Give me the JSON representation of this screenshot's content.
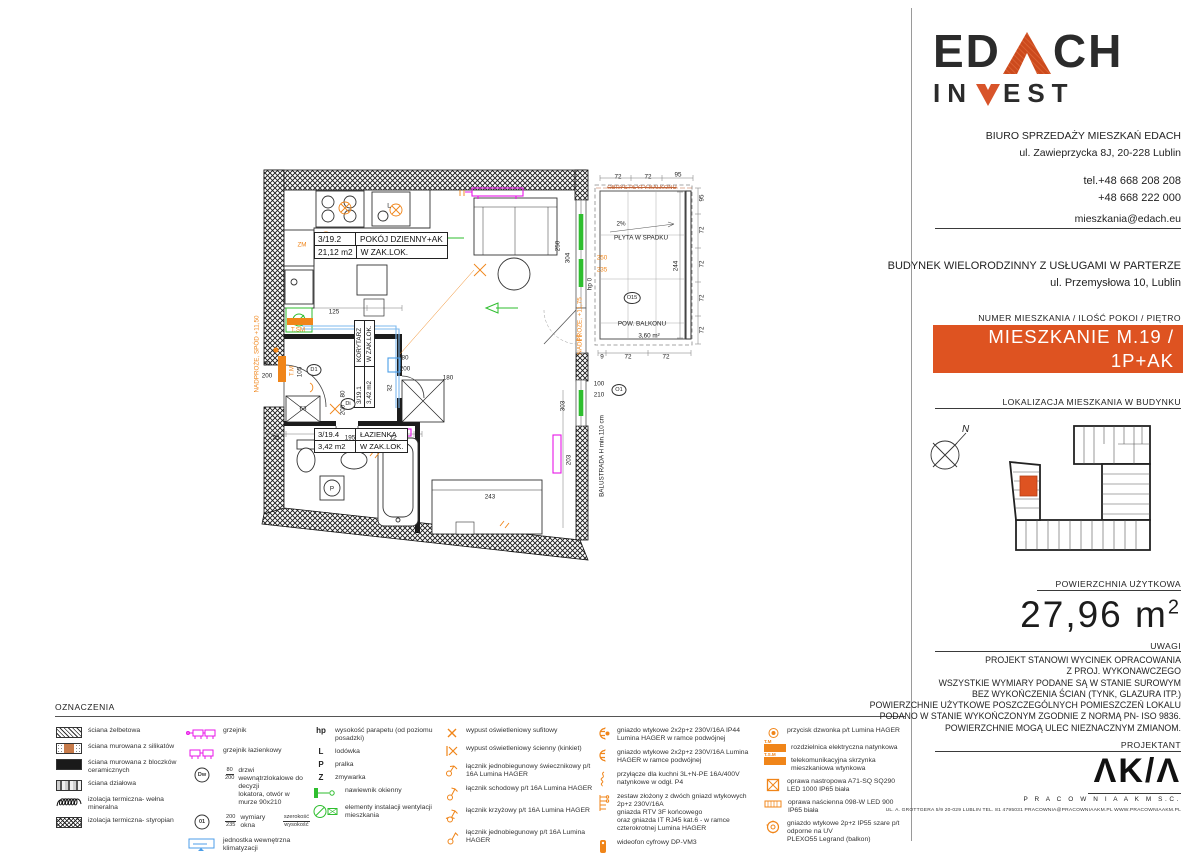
{
  "right_panel": {
    "logo_line1_a": "ED",
    "logo_line1_b": "CH",
    "logo_line2_a": "IN",
    "logo_line2_b": "EST",
    "office_line1": "BIURO SPRZEDAŻY MIESZKAŃ EDACH",
    "office_line2": "ul. Zawieprzycka 8J, 20-228 Lublin",
    "tel1": "tel.+48 668 208 208",
    "tel2": "+48 668 222 000",
    "email": "mieszkania@edach.eu",
    "building_line1": "BUDYNEK WIELORODZINNY Z USŁUGAMI W PARTERZE",
    "building_line2": "ul. Przemysłowa 10, Lublin",
    "unit_header": "NUMER MIESZKANIA / ILOŚĆ POKOI / PIĘTRO",
    "banner_line1": "MIESZKANIE M.19 / 1P+AK",
    "banner_line2": "PIĘTRO 3",
    "location_header": "LOKALIZACJA MIESZKANIA W BUDYNKU",
    "compass_n": "N",
    "area_header": "POWIERZCHNIA UŻYTKOWA",
    "area_value": "27,96 m",
    "area_sup": "2",
    "uwagi_header": "UWAGI",
    "uwagi_lines": [
      "PROJEKT STANOWI WYCINEK OPRACOWANIA",
      "Z PROJ. WYKONAWCZEGO",
      "WSZYSTKIE WYMIARY PODANE SĄ W STANIE SUROWYM",
      "BEZ WYKOŃCZENIA ŚCIAN (TYNK, GLAZURA ITP.)",
      "POWIERZCHNIE UŻYTKOWE POSZCZEGÓLNYCH POMIESZCZEŃ LOKALU",
      "PODANO W STANIE WYKOŃCZONYM ZGODNIE Z NORMĄ PN- ISO 9836.",
      "POWIERZCHNIE MOGĄ ULEC NIEZNACZNYM ZMIANOM."
    ],
    "projektant_header": "PROJEKTANT",
    "akm_logo": "ΛΚ/Λ",
    "akm_sub": "P R A C O W N I A   A K M   S.C.",
    "akm_footer": "UL. A. GROTTGERA 5/9  20-029 LUBLIN  TEL. 81 4795031  PRACOWNIA@PRACOWNIAAKM.PL  WWW.PRACOWNIAAKM.PL"
  },
  "colors": {
    "accent_orange": "#DE5321",
    "symbol_orange": "#F08519",
    "magenta": "#E816E8",
    "green": "#2EBE2E",
    "blue": "#4C9EE8"
  },
  "legend": {
    "title": "OZNACZENIA",
    "columns": [
      {
        "items": [
          {
            "icon": "hatch",
            "label": "ściana żelbetowa"
          },
          {
            "icon": "silikat",
            "label": "ściana murowana z silikatów"
          },
          {
            "icon": "solid",
            "label": "ściana murowana z bloczków ceramicznych"
          },
          {
            "icon": "dzialowa",
            "label": "ściana działowa"
          },
          {
            "icon": "wool",
            "label": "izolacja termiczna- wełna mineralna"
          },
          {
            "icon": "styro",
            "label": "izolacja termiczna- styropian"
          }
        ]
      },
      {
        "items": [
          {
            "icon": "radiator",
            "label": "grzejnik"
          },
          {
            "icon": "radiator-bath",
            "label": "grzejnik łazienkowy"
          },
          {
            "icon": "circle",
            "cap": "Dw",
            "fr": "80/200",
            "label": "drzwi wewnątrzlokalowe do decyzji\nlokatora, otwór w murze 90x210"
          },
          {
            "icon": "circle",
            "cap": "01",
            "fr": "200/235",
            "label": "wymiary okna",
            "fr2": "szerokość/wysokość"
          },
          {
            "icon": "klima",
            "label": "jednostka wewnętrzna klimatyzacji"
          }
        ]
      },
      {
        "items": [
          {
            "icon": "letter",
            "cap": "hp",
            "label": "wysokość parapetu (od poziomu posadzki)"
          },
          {
            "icon": "letter",
            "cap": "L",
            "label": "lodówka"
          },
          {
            "icon": "letter",
            "cap": "P",
            "label": "pralka"
          },
          {
            "icon": "letter",
            "cap": "Z",
            "label": "zmywarka"
          },
          {
            "icon": "nawiewnik",
            "label": "nawiewnik okienny"
          },
          {
            "icon": "vent",
            "label": "elementy instalacji wentylacji mieszkania"
          }
        ]
      },
      {
        "items": [
          {
            "icon": "lampx",
            "label": "wypust oświetleniowy sufitowy"
          },
          {
            "icon": "lampwall",
            "label": "wypust oświetleniowy ścienny (kinkiet)"
          },
          {
            "icon": "sw-swiecznik",
            "label": "łącznik jednobiegunowy świecznikowy  p/t 16A Lumina HAGER"
          },
          {
            "icon": "sw-schodowy",
            "label": "łącznik schodowy  p/t 16A Lumina HAGER"
          },
          {
            "icon": "sw-krzyzowy",
            "label": "łącznik krzyżowy  p/t 16A Lumina HAGER"
          },
          {
            "icon": "sw-jedno",
            "label": "łącznik jednobiegunowy p/t 16A Lumina HAGER"
          }
        ]
      },
      {
        "items": [
          {
            "icon": "socket44",
            "label": "gniazdo wtykowe 2x2p+z 230V/16A IP44 Lumina HAGER w ramce podwójnej"
          },
          {
            "icon": "socket",
            "label": "gniazdo wtykowe 2x2p+z 230V/16A Lumina HAGER w ramce podwójnej"
          },
          {
            "icon": "kuchnia",
            "label": "przyłącze dla kuchni 3L+N-PE 16A/400V natynkowe w odgł. P4"
          },
          {
            "icon": "zestaw",
            "label": "zestaw złożony z dwóch gniazd wtykowych 2p+z 230V/16A\ngniazda RTV 3F końcowego\noraz gniazda IT RJ45 kat.6 - w ramce czterokrotnej Lumina HAGER"
          },
          {
            "icon": "wideofon",
            "label": "wideofon cyfrowy DP-VM3"
          }
        ]
      },
      {
        "items": [
          {
            "icon": "dzwonek",
            "label": "przycisk dzwonka p/t Lumina HAGER"
          },
          {
            "icon": "boxfill",
            "capTop": "T.M",
            "label": "rozdzielnica elektryczna natynkowa"
          },
          {
            "icon": "boxfill",
            "capTop": "T.S.M",
            "label": "telekomunikacyjna skrzynka mieszkaniowa wtynkowa"
          },
          {
            "icon": "oprawa-sufit",
            "label": "oprawa nastropowa A71-SQ SQ290 LED 1000 IP65 biała"
          },
          {
            "icon": "oprawa-scienna",
            "label": "oprawa naścienna 098-W LED 900 IP65 biała"
          },
          {
            "icon": "gniazdo55",
            "label": "gniazdo wtykowe 2p+z IP55 szare p/t odporne na UV\nPLEXO55 Legrand (balkon)"
          }
        ]
      }
    ]
  },
  "plan": {
    "rooms": {
      "living": {
        "num": "3/19.2",
        "name": "POKÓJ DZIENNY+AK",
        "area": "21,12 m2",
        "note": "W ZAK.LOK."
      },
      "corridor": {
        "num": "3/19.1",
        "name": "KORYTARZ",
        "area": "3,42 m2",
        "note": "W ZAK.LOK."
      },
      "bath": {
        "num": "3/19.4",
        "name": "ŁAZIENKA",
        "area": "3,42 m2",
        "note": "W ZAK.LOK."
      }
    },
    "labels": [
      {
        "t": "72",
        "x": 368,
        "y": 19
      },
      {
        "t": "72",
        "x": 398,
        "y": 19
      },
      {
        "t": "95",
        "x": 428,
        "y": 17
      },
      {
        "t": "9",
        "x": 352,
        "y": 199
      },
      {
        "t": "72",
        "x": 378,
        "y": 199
      },
      {
        "t": "72",
        "x": 416,
        "y": 199
      },
      {
        "t": "95",
        "x": 452,
        "y": 40,
        "r": 1
      },
      {
        "t": "72",
        "x": 452,
        "y": 72,
        "r": 1
      },
      {
        "t": "72",
        "x": 452,
        "y": 106,
        "r": 1
      },
      {
        "t": "72",
        "x": 452,
        "y": 140,
        "r": 1
      },
      {
        "t": "72",
        "x": 452,
        "y": 172,
        "r": 1
      },
      {
        "t": "244",
        "x": 426,
        "y": 108,
        "r": 1
      },
      {
        "t": "304",
        "x": 318,
        "y": 100,
        "r": 1
      },
      {
        "t": "250",
        "x": 308,
        "y": 88,
        "r": 1
      },
      {
        "t": "hp 0",
        "x": 340,
        "y": 126,
        "r": 1
      },
      {
        "t": "250",
        "x": 352,
        "y": 100,
        "c": "org"
      },
      {
        "t": "235",
        "x": 352,
        "y": 112,
        "c": "org"
      },
      {
        "t": "2%",
        "x": 371,
        "y": 66
      },
      {
        "t": "PŁYTA W SPADKU",
        "x": 391,
        "y": 80
      },
      {
        "t": "POW. BALKONU",
        "x": 392,
        "y": 166
      },
      {
        "t": "3,60 m²",
        "x": 399,
        "y": 178
      },
      {
        "t": "OBRYS PŁYTY BALKONU",
        "x": 392,
        "y": 30,
        "c": "strike"
      },
      {
        "t": "O15",
        "x": 382,
        "y": 140,
        "c": "circ"
      },
      {
        "t": "125",
        "x": 84,
        "y": 154
      },
      {
        "t": "80",
        "x": 155,
        "y": 200
      },
      {
        "t": "200",
        "x": 155,
        "y": 211
      },
      {
        "t": "180",
        "x": 198,
        "y": 220
      },
      {
        "t": "90",
        "x": 17,
        "y": 206
      },
      {
        "t": "200",
        "x": 17,
        "y": 218
      },
      {
        "t": "105",
        "x": 50,
        "y": 214,
        "r": 1
      },
      {
        "t": "D1",
        "x": 64,
        "y": 212,
        "c": "circ"
      },
      {
        "t": "Di",
        "x": 98,
        "y": 246,
        "c": "circ"
      },
      {
        "t": "63",
        "x": 53,
        "y": 251
      },
      {
        "t": "32",
        "x": 140,
        "y": 230,
        "r": 1
      },
      {
        "t": "80",
        "x": 93,
        "y": 236,
        "r": 1
      },
      {
        "t": "200",
        "x": 93,
        "y": 252,
        "r": 1
      },
      {
        "t": "L",
        "x": 139,
        "y": 48
      },
      {
        "t": "P",
        "x": 82,
        "y": 331
      },
      {
        "t": "35",
        "x": 26,
        "y": 280
      },
      {
        "t": "195",
        "x": 100,
        "y": 280
      },
      {
        "t": "12",
        "x": 143,
        "y": 280
      },
      {
        "t": "243",
        "x": 240,
        "y": 339
      },
      {
        "t": "303",
        "x": 313,
        "y": 248,
        "r": 1
      },
      {
        "t": "203",
        "x": 319,
        "y": 302,
        "r": 1
      },
      {
        "t": "100",
        "x": 349,
        "y": 226
      },
      {
        "t": "210",
        "x": 349,
        "y": 237
      },
      {
        "t": "O1",
        "x": 369,
        "y": 232,
        "c": "circ"
      },
      {
        "t": "ZM",
        "x": 52,
        "y": 87,
        "c": "org"
      },
      {
        "t": "T.SM",
        "x": 48,
        "y": 172,
        "c": "org"
      },
      {
        "t": "T.M",
        "x": 42,
        "y": 213,
        "c": "org",
        "r": 1
      },
      {
        "t": "NADPROŻE, SPÓD +11,50",
        "x": 7,
        "y": 196,
        "c": "org",
        "r": 1
      },
      {
        "t": "NADPROŻE, +11,75",
        "x": 330,
        "y": 168,
        "c": "org",
        "r": 1
      },
      {
        "t": "BALUSTRADA H min.110 cm",
        "x": 352,
        "y": 298,
        "r": 1
      }
    ]
  }
}
